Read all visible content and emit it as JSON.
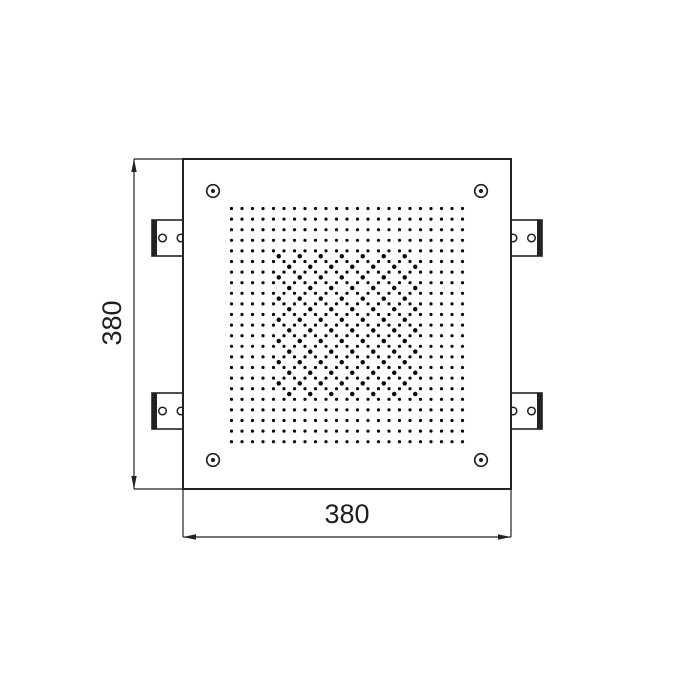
{
  "drawing": {
    "kind": "technical-dimension-drawing",
    "subject": "square ceiling shower head plate, front view",
    "background_color": "#ffffff",
    "line_color": "#222222",
    "dot_color": "#0a0a0a"
  },
  "dimensions": {
    "width": {
      "label": "380",
      "line": {
        "y": 537,
        "x1": 183,
        "x2": 511
      },
      "extensions": [
        {
          "x1": 183,
          "y1": 490,
          "x2": 183,
          "y2": 537
        },
        {
          "x1": 511,
          "y1": 490,
          "x2": 511,
          "y2": 537
        }
      ],
      "label_pos": {
        "x": 347,
        "y": 523,
        "rotate": 0
      }
    },
    "height": {
      "label": "380",
      "line": {
        "x": 134,
        "y1": 159,
        "y2": 489
      },
      "extensions": [
        {
          "x1": 134,
          "y1": 159,
          "x2": 182,
          "y2": 159
        },
        {
          "x1": 134,
          "y1": 489,
          "x2": 182,
          "y2": 489
        }
      ],
      "label_pos": {
        "x": 121,
        "y": 323,
        "rotate": -90
      }
    },
    "font_size": 27
  },
  "plate": {
    "x": 183,
    "y": 159,
    "width": 328,
    "height": 330,
    "stroke_width": 2
  },
  "corner_screws": {
    "outer_radius": 6.3,
    "inner_radius": 2.1,
    "stroke_width": 1.7,
    "positions": [
      {
        "id": "top-left",
        "cx": 213,
        "cy": 191
      },
      {
        "id": "top-right",
        "cx": 481,
        "cy": 191
      },
      {
        "id": "bottom-left",
        "cx": 213,
        "cy": 460
      },
      {
        "id": "bottom-right",
        "cx": 481,
        "cy": 460
      }
    ]
  },
  "mounting_brackets": {
    "stroke_width": 1.6,
    "thick_bar_width": 5,
    "hole_radius": 3.8,
    "hole_stroke_width": 1.5,
    "items": [
      {
        "id": "top-left",
        "x": 152,
        "y": 220,
        "width": 32,
        "height": 36,
        "thick_side": "left",
        "holes": [
          {
            "cx": 162.5,
            "cy": 238
          },
          {
            "cx": 181,
            "cy": 238
          }
        ]
      },
      {
        "id": "bottom-left",
        "x": 152,
        "y": 393,
        "width": 32,
        "height": 36,
        "thick_side": "left",
        "holes": [
          {
            "cx": 162.5,
            "cy": 411
          },
          {
            "cx": 181,
            "cy": 411
          }
        ]
      },
      {
        "id": "top-right",
        "x": 510,
        "y": 220,
        "width": 32,
        "height": 36,
        "thick_side": "right",
        "holes": [
          {
            "cx": 513,
            "cy": 238
          },
          {
            "cx": 531.5,
            "cy": 238
          }
        ]
      },
      {
        "id": "bottom-right",
        "x": 510,
        "y": 393,
        "width": 32,
        "height": 36,
        "thick_side": "right",
        "holes": [
          {
            "cx": 513,
            "cy": 411
          },
          {
            "cx": 531.5,
            "cy": 411
          }
        ]
      }
    ]
  },
  "nozzle_grid": {
    "cols": 23,
    "rows": 23,
    "x0": 231.5,
    "y0": 208.5,
    "pitch_x": 10.5,
    "pitch_y": 10.6,
    "dot_radius": 1.6
  },
  "center_nozzle_pattern": {
    "description": "extra nozzles at cell centers, checkerboard, central region",
    "i_min": 4,
    "i_max": 17,
    "j_min": 4,
    "j_max": 17,
    "parity": "even",
    "dot_radius": 2.25
  },
  "arrow": {
    "length": 13,
    "half_width": 2.7
  }
}
